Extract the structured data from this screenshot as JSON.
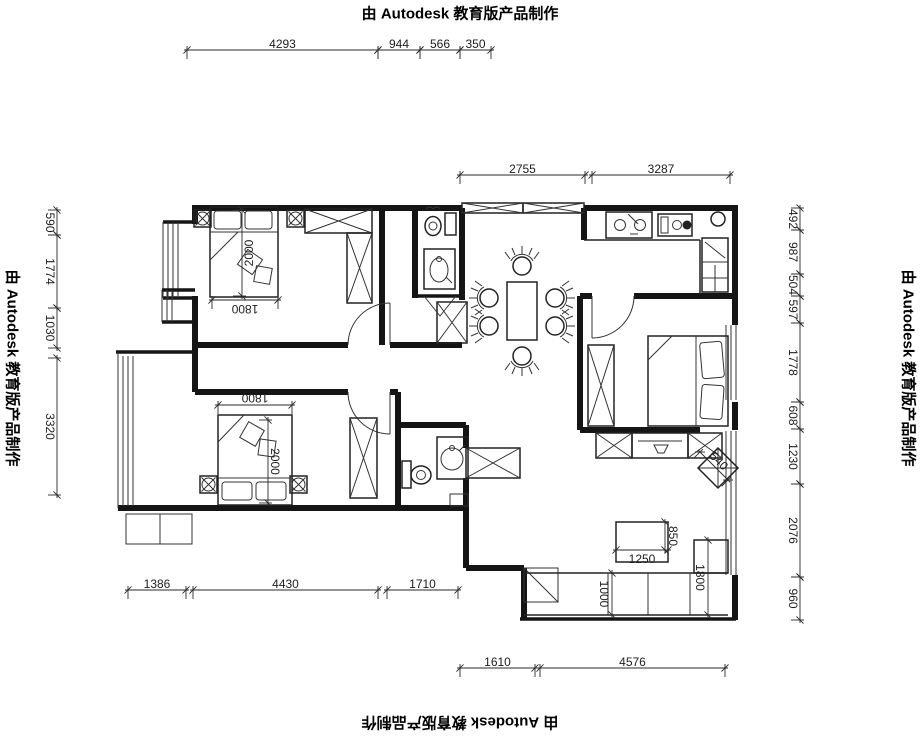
{
  "watermark": {
    "text": "由 Autodesk 教育版产品制作",
    "instances": [
      {
        "name": "watermark-top",
        "x": 460,
        "y": 14,
        "rot": 0
      },
      {
        "name": "watermark-right",
        "x": 908,
        "y": 368,
        "rot": 90
      },
      {
        "name": "watermark-left",
        "x": 12,
        "y": 368,
        "rot": 90
      },
      {
        "name": "watermark-bottom",
        "x": 460,
        "y": 722,
        "rot": 180
      }
    ]
  },
  "colors": {
    "background": "#ffffff",
    "line": "#151515",
    "dim_text": "#1d1d1d"
  },
  "dimensions": [
    {
      "label": "4293",
      "x1": 187,
      "y1": 50,
      "x2": 378,
      "y2": 50,
      "rot": 0,
      "off": 6
    },
    {
      "label": "944",
      "x1": 378,
      "y1": 50,
      "x2": 420,
      "y2": 50,
      "rot": 0,
      "off": 6
    },
    {
      "label": "566",
      "x1": 420,
      "y1": 50,
      "x2": 460,
      "y2": 50,
      "rot": 0,
      "off": 6
    },
    {
      "label": "350",
      "x1": 460,
      "y1": 50,
      "x2": 491,
      "y2": 50,
      "rot": 0,
      "off": 6
    },
    {
      "label": "2755",
      "x1": 460,
      "y1": 175,
      "x2": 585,
      "y2": 175,
      "rot": 0,
      "off": 6
    },
    {
      "label": "3287",
      "x1": 592,
      "y1": 175,
      "x2": 730,
      "y2": 175,
      "rot": 0,
      "off": 6
    },
    {
      "label": "590",
      "x1": 57,
      "y1": 210,
      "x2": 57,
      "y2": 235,
      "rot": 90,
      "off": -7
    },
    {
      "label": "1774",
      "x1": 57,
      "y1": 235,
      "x2": 57,
      "y2": 308,
      "rot": 90,
      "off": -7
    },
    {
      "label": "1030",
      "x1": 57,
      "y1": 308,
      "x2": 57,
      "y2": 348,
      "rot": 90,
      "off": -7
    },
    {
      "label": "3320",
      "x1": 57,
      "y1": 358,
      "x2": 57,
      "y2": 495,
      "rot": 90,
      "off": -7
    },
    {
      "label": "492",
      "x1": 800,
      "y1": 208,
      "x2": 800,
      "y2": 230,
      "rot": 90,
      "off": -7
    },
    {
      "label": "987",
      "x1": 800,
      "y1": 230,
      "x2": 800,
      "y2": 274,
      "rot": 90,
      "off": -7
    },
    {
      "label": "504",
      "x1": 800,
      "y1": 274,
      "x2": 800,
      "y2": 296,
      "rot": 90,
      "off": -7
    },
    {
      "label": "597",
      "x1": 800,
      "y1": 296,
      "x2": 800,
      "y2": 323,
      "rot": 90,
      "off": -7
    },
    {
      "label": "1778",
      "x1": 800,
      "y1": 323,
      "x2": 800,
      "y2": 402,
      "rot": 90,
      "off": -7
    },
    {
      "label": "608",
      "x1": 800,
      "y1": 402,
      "x2": 800,
      "y2": 429,
      "rot": 90,
      "off": -7
    },
    {
      "label": "1230",
      "x1": 800,
      "y1": 429,
      "x2": 800,
      "y2": 484,
      "rot": 90,
      "off": -7
    },
    {
      "label": "2076",
      "x1": 800,
      "y1": 484,
      "x2": 800,
      "y2": 577,
      "rot": 90,
      "off": -7
    },
    {
      "label": "960",
      "x1": 800,
      "y1": 577,
      "x2": 800,
      "y2": 620,
      "rot": 90,
      "off": -7
    },
    {
      "label": "1386",
      "x1": 128,
      "y1": 590,
      "x2": 186,
      "y2": 590,
      "rot": 0,
      "off": 6
    },
    {
      "label": "4430",
      "x1": 193,
      "y1": 590,
      "x2": 378,
      "y2": 590,
      "rot": 0,
      "off": 6
    },
    {
      "label": "1710",
      "x1": 387,
      "y1": 590,
      "x2": 458,
      "y2": 590,
      "rot": 0,
      "off": 6
    },
    {
      "label": "1610",
      "x1": 460,
      "y1": 668,
      "x2": 535,
      "y2": 668,
      "rot": 0,
      "off": 6
    },
    {
      "label": "4576",
      "x1": 540,
      "y1": 668,
      "x2": 725,
      "y2": 668,
      "rot": 0,
      "off": 6
    },
    {
      "label": "2000",
      "x1": 242,
      "y1": 210,
      "x2": 242,
      "y2": 296,
      "rot": -90,
      "off": 7
    },
    {
      "label": "1800",
      "x1": 212,
      "y1": 300,
      "x2": 278,
      "y2": 300,
      "rot": 180,
      "off": -9
    },
    {
      "label": "1800",
      "x1": 218,
      "y1": 405,
      "x2": 292,
      "y2": 405,
      "rot": 180,
      "off": 7
    },
    {
      "label": "2000",
      "x1": 268,
      "y1": 420,
      "x2": 268,
      "y2": 503,
      "rot": 90,
      "off": 7
    },
    {
      "label": "1250",
      "x1": 616,
      "y1": 550,
      "x2": 668,
      "y2": 550,
      "rot": 0,
      "off": -9
    },
    {
      "label": "850",
      "x1": 665,
      "y1": 522,
      "x2": 665,
      "y2": 550,
      "rot": 90,
      "off": 8
    },
    {
      "label": "1000",
      "x1": 612,
      "y1": 573,
      "x2": 612,
      "y2": 615,
      "rot": 90,
      "off": -8
    },
    {
      "label": "1800",
      "x1": 708,
      "y1": 540,
      "x2": 708,
      "y2": 615,
      "rot": 90,
      "off": -8
    },
    {
      "label": "540",
      "x1": 700,
      "y1": 452,
      "x2": 728,
      "y2": 480,
      "rot": 45,
      "off": 7
    }
  ]
}
